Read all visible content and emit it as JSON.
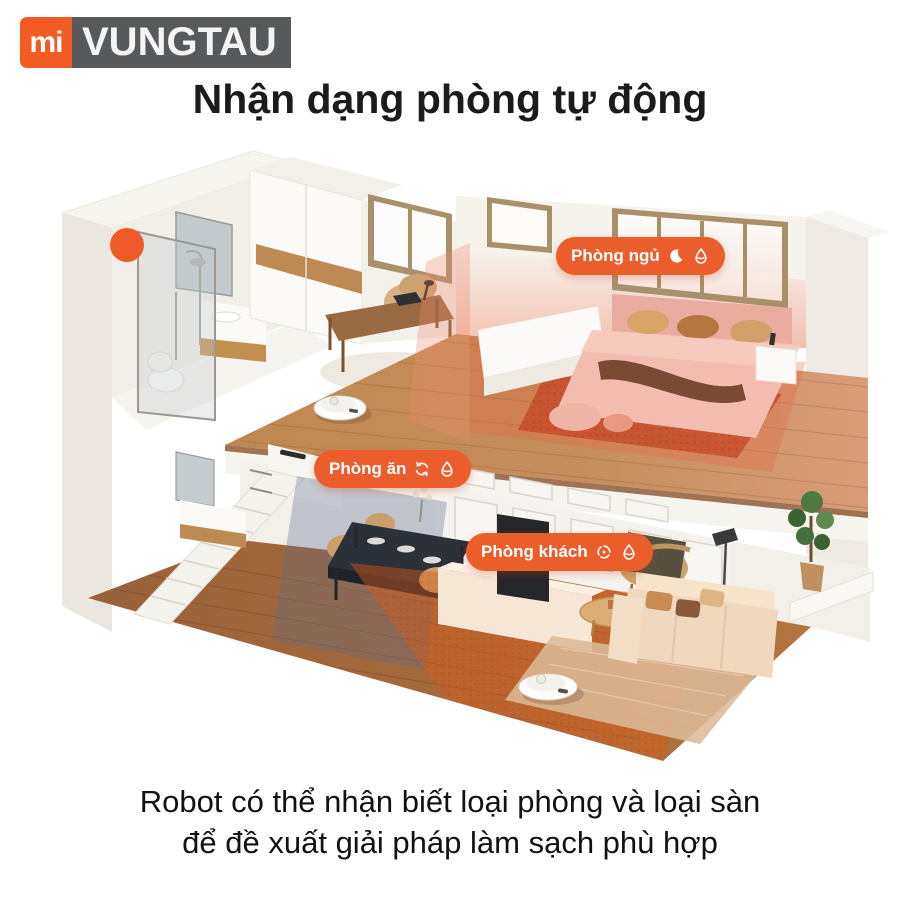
{
  "brand": {
    "mi": "mi",
    "name": "VUNGTAU"
  },
  "title": "Nhận dạng phòng tự động",
  "caption": {
    "line1": "Robot có thể nhận biết loại phòng và loại sàn",
    "line2": "để đề xuất giải pháp làm sạch phù hợp"
  },
  "badges": [
    {
      "id": "bedroom",
      "label": "Phòng ngủ",
      "icons": [
        "moon-icon",
        "drop-icon"
      ]
    },
    {
      "id": "dining",
      "label": "Phòng ăn",
      "icons": [
        "refresh-icon",
        "drop-icon"
      ]
    },
    {
      "id": "living",
      "label": "Phòng khách",
      "icons": [
        "fan-icon",
        "drop-icon"
      ]
    }
  ],
  "colors": {
    "badge_orange": "#EB5D2B",
    "logo_orange": "#F25B22",
    "logo_gray": "#58595B",
    "bedroom_zone_red": "#E05A34",
    "dining_zone_blue": "#5C6A90",
    "living_zone_orange": "#D95C1C",
    "shower_marker_orange": "#F05A28"
  }
}
